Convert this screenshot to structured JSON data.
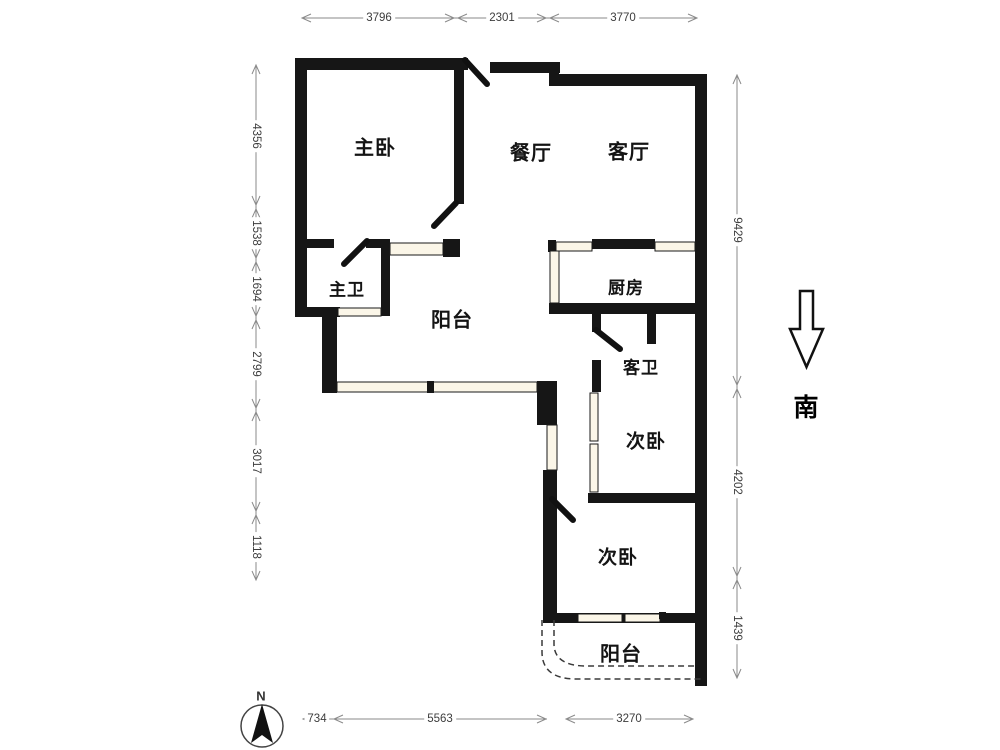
{
  "rooms": [
    {
      "id": "master-bedroom",
      "label": "主卧"
    },
    {
      "id": "dining-room",
      "label": "餐厅"
    },
    {
      "id": "living-room",
      "label": "客厅"
    },
    {
      "id": "master-bathroom",
      "label": "主卫"
    },
    {
      "id": "balcony-north",
      "label": "阳台"
    },
    {
      "id": "kitchen",
      "label": "厨房"
    },
    {
      "id": "guest-bathroom",
      "label": "客卫"
    },
    {
      "id": "second-bedroom-upper",
      "label": "次卧"
    },
    {
      "id": "second-bedroom-lower",
      "label": "次卧"
    },
    {
      "id": "balcony-south",
      "label": "阳台"
    }
  ],
  "dimensions": {
    "top": [
      "3796",
      "2301",
      "3770"
    ],
    "left": [
      "4356",
      "1538",
      "1694",
      "2799",
      "3017",
      "1118"
    ],
    "right": [
      "9429",
      "4202",
      "1439"
    ],
    "bottom": [
      "734",
      "5563",
      "3270"
    ]
  },
  "compass": {
    "north_label": "N"
  },
  "orientation": {
    "south_label": "南"
  },
  "colors": {
    "wall": "#161616",
    "window_fill": "#fbf6e8",
    "window_stroke": "#1a1a1a",
    "dimension_line": "#8a8a8a",
    "dimension_text": "#3d3d3d",
    "dashed_outline": "#3a3a3a",
    "background": "#ffffff"
  }
}
